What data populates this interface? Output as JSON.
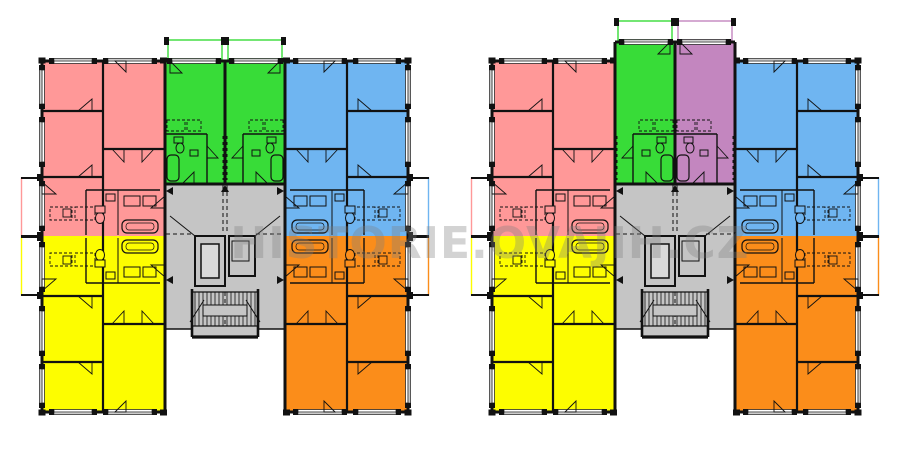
{
  "watermark": {
    "text": "HISTORIE.OVAJIH.CZ",
    "color_rgba": "rgba(125,125,125,0.34)"
  },
  "background": "#ffffff",
  "wall_color": "#111111",
  "palette": {
    "pink": "#FF9898",
    "green": "#38DC38",
    "blue": "#6FB5F1",
    "yellow": "#FDFD00",
    "orange": "#FB8D1A",
    "purple": "#C386BF",
    "gray": "#C5C5C5",
    "elevator_inner": "#DADADA",
    "window_line": "#999999",
    "window_fill": "#FFFFFF"
  },
  "plans": [
    {
      "name": "floor-plan-left",
      "wing_units": {
        "top_left": "pink",
        "top_right": "blue",
        "bottom_left": "yellow",
        "bottom_right": "orange"
      },
      "center_units": [
        "green",
        "green"
      ],
      "center_extended": false,
      "core": "gray"
    },
    {
      "name": "floor-plan-right",
      "wing_units": {
        "top_left": "pink",
        "top_right": "blue",
        "bottom_left": "yellow",
        "bottom_right": "orange"
      },
      "center_units": [
        "green",
        "purple"
      ],
      "center_extended": true,
      "core": "gray"
    }
  ]
}
